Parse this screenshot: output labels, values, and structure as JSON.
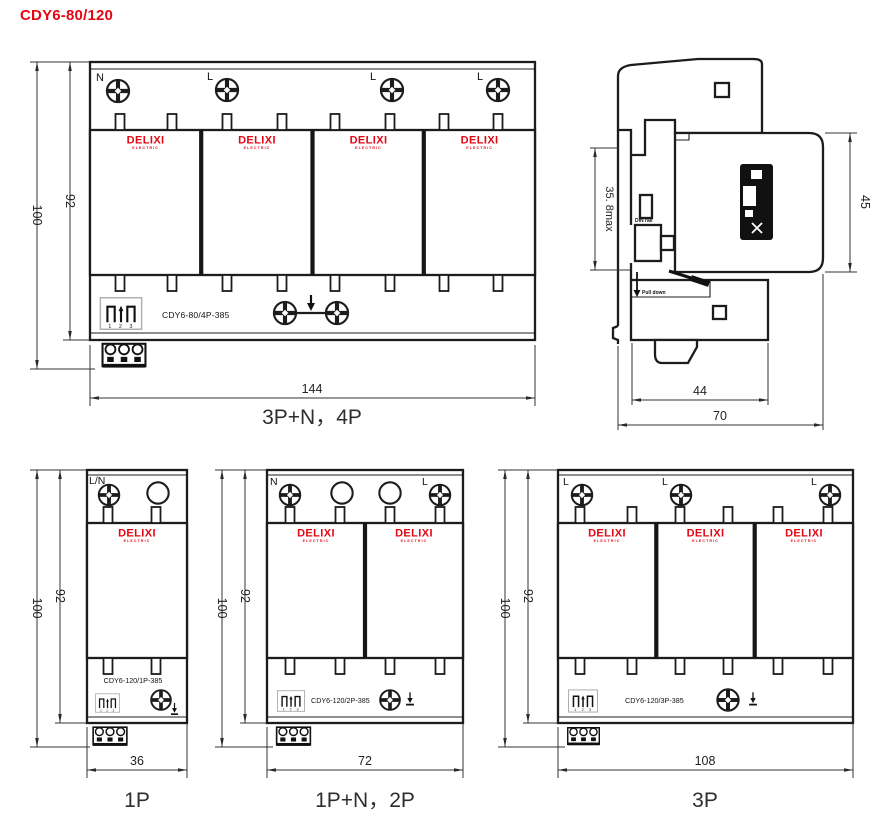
{
  "title": "CDY6-80/120",
  "brand": {
    "name": "DELIXI",
    "sub": "ELECTRIC"
  },
  "connector": {
    "pins": "1 2 3"
  },
  "colors": {
    "brand_red": "#e30613",
    "line": "#1c1c1c",
    "caption": "#2e2e2e"
  },
  "views": {
    "p4": {
      "caption": "3P+N，4P",
      "model": "CDY6-80/4P-385",
      "terminals": [
        "N",
        "L",
        "L",
        "L"
      ],
      "dims": {
        "outer_height": "100",
        "body_height": "92",
        "width": "144"
      }
    },
    "p1": {
      "caption": "1P",
      "model": "CDY6-120/1P-385",
      "terminals": [
        "L/N"
      ],
      "dims": {
        "outer_height": "100",
        "body_height": "92",
        "width": "36"
      }
    },
    "p2": {
      "caption": "1P+N，2P",
      "model": "CDY6-120/2P-385",
      "terminals": [
        "N",
        "L"
      ],
      "dims": {
        "outer_height": "100",
        "body_height": "92",
        "width": "72"
      }
    },
    "p3": {
      "caption": "3P",
      "model": "CDY6-120/3P-385",
      "terminals": [
        "L",
        "L",
        "L"
      ],
      "dims": {
        "outer_height": "100",
        "body_height": "92",
        "width": "108"
      }
    },
    "side": {
      "dims": {
        "depth_upper": "35. 8max",
        "height": "45",
        "depth_body": "44",
        "depth_total": "70"
      },
      "notes": {
        "rail": "DIN rail",
        "release": "Pull down"
      }
    }
  }
}
